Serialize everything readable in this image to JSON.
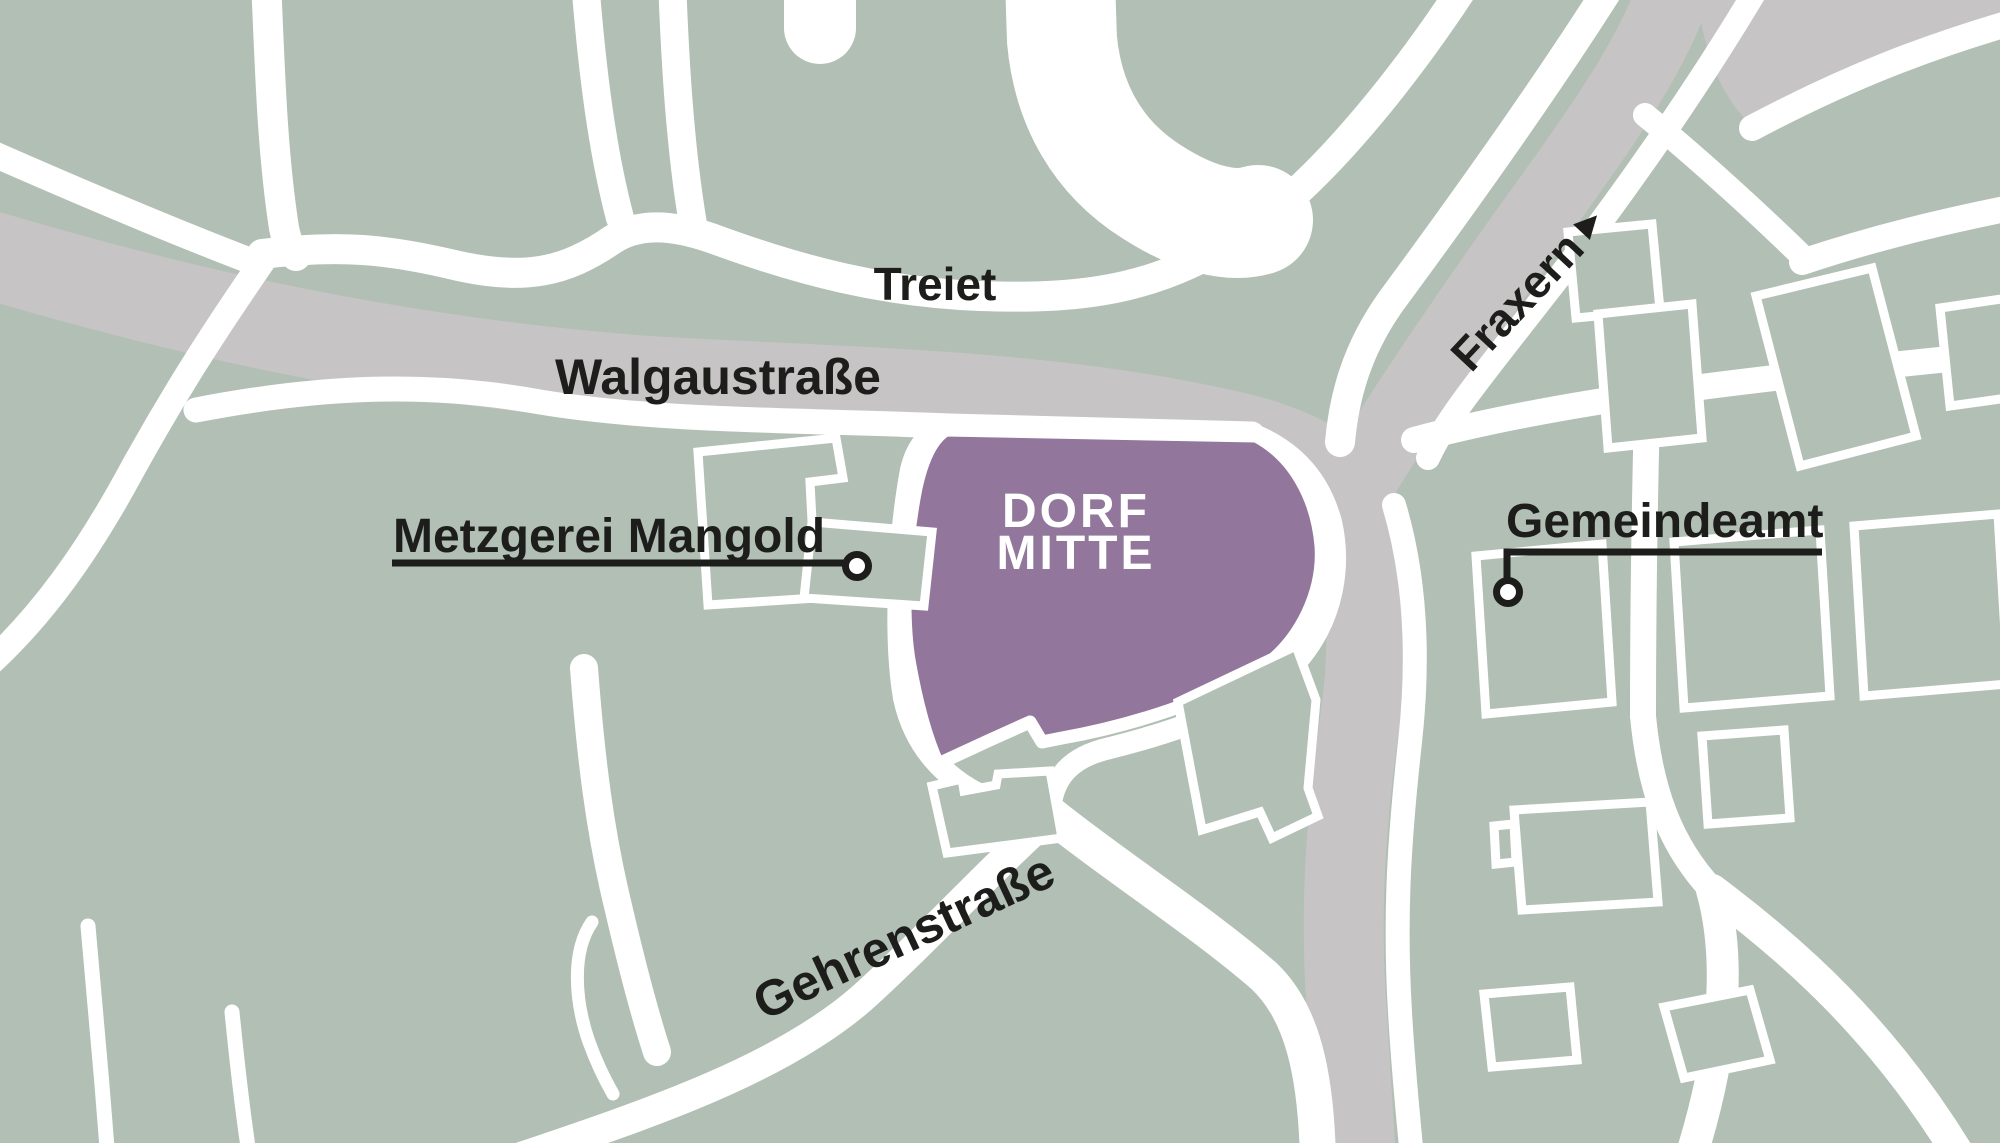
{
  "map": {
    "kind": "village-center locator map",
    "highlight": {
      "name_line1": "DORF",
      "name_line2": "MITTE"
    },
    "streets": {
      "treiet": "Treiet",
      "walgaustrasse": "Walgaustraße",
      "fraxern": "Fraxern",
      "fraxern_direction_arrow": "▸",
      "gehrenstrasse": "Gehrenstraße"
    },
    "pois": [
      {
        "label": "Metzgerei Mangold"
      },
      {
        "label": "Gemeindeamt"
      }
    ],
    "colors": {
      "land_green": "#b1bfb4",
      "main_road_gray": "#c6c4c4",
      "road_white": "#ffffff",
      "highlight_purple": "#92769b",
      "label_ink": "#1d1d1b",
      "highlight_label": "#ffffff"
    }
  }
}
